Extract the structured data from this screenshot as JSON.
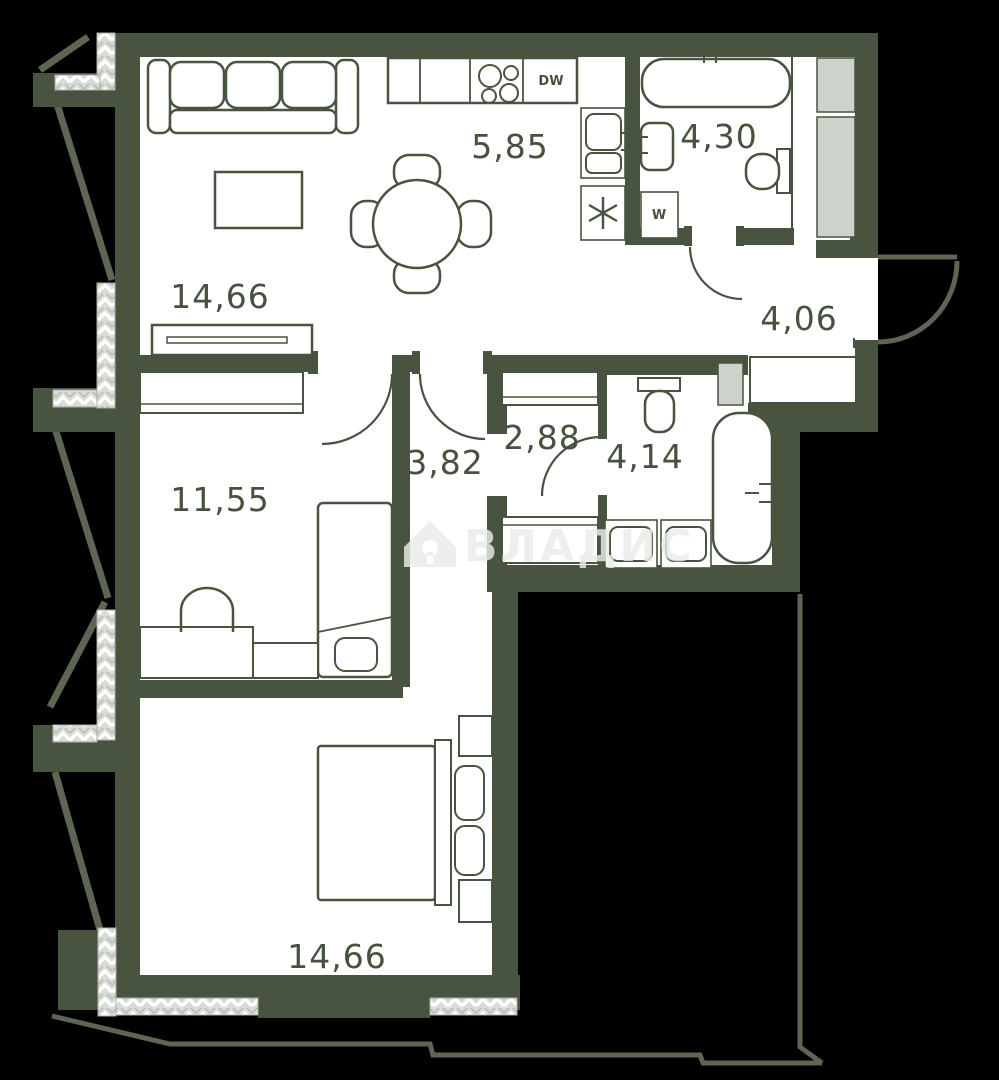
{
  "plan": {
    "title": "apartment floor plan",
    "rooms": [
      {
        "id": "living-room",
        "area": "14,66"
      },
      {
        "id": "kitchen",
        "area": "5,85"
      },
      {
        "id": "bathroom-top",
        "area": "4,30"
      },
      {
        "id": "entry-hall",
        "area": "4,06"
      },
      {
        "id": "wardrobe-room",
        "area": "2,88"
      },
      {
        "id": "corridor",
        "area": "3,82"
      },
      {
        "id": "bathroom-middle",
        "area": "4,14"
      },
      {
        "id": "bedroom-left",
        "area": "11,55"
      },
      {
        "id": "bedroom-bottom",
        "area": "14,66"
      }
    ],
    "appliances": {
      "dishwasher": "DW",
      "washer": "W",
      "shaft_symbol": "asterisk"
    },
    "watermark": {
      "text": "ВЛАДИС",
      "icon": "house-key-icon"
    },
    "colors": {
      "background": "#000000",
      "wall": "#48543F",
      "facade": "#5D6553",
      "room": "#FFFFFF",
      "hatch": "#D9DCD6",
      "shaft": "#CDD2CA",
      "label": "#46523E",
      "watermark": "#E9ECE8"
    }
  }
}
